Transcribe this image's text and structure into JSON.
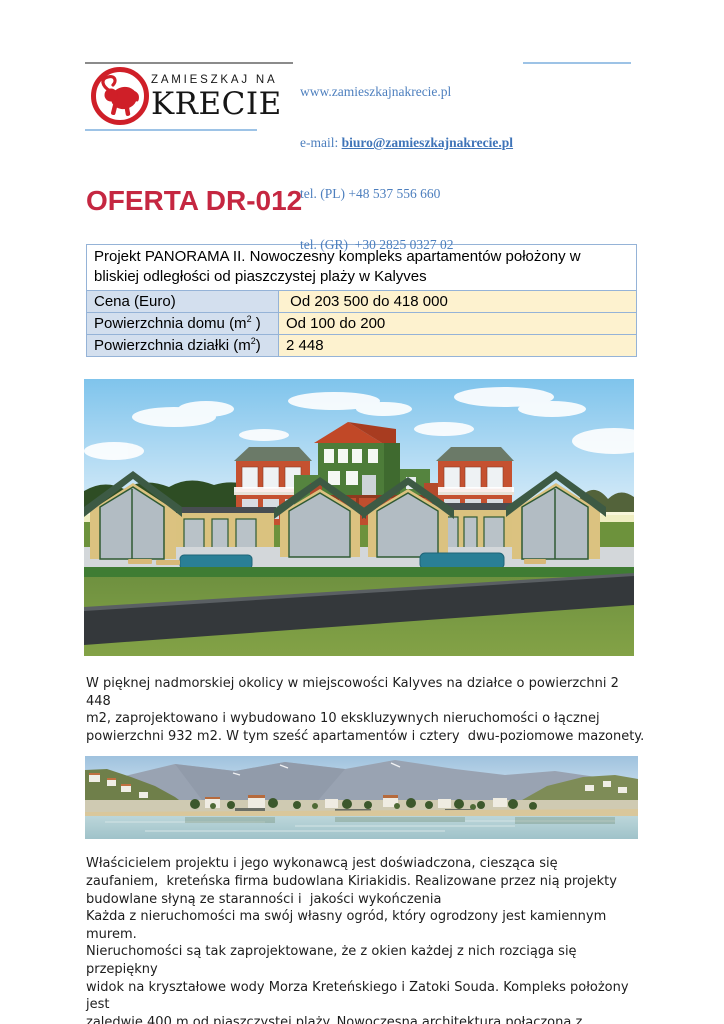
{
  "header": {
    "logo": {
      "line1": "ZAMIESZKAJ NA",
      "line2": "KRECIE",
      "icon": "bull-icon"
    },
    "website": "www.zamieszkajnakrecie.pl",
    "email_label": "e-mail: ",
    "email": "biuro@zamieszkajnakrecie.pl",
    "phone_pl": "tel. (PL) +48 537 556 660",
    "phone_gr": "tel. (GR)  +30 2825 0327 02"
  },
  "title": "OFERTA DR-012",
  "offer_table": {
    "header": "Projekt PANORAMA II. Nowoczesny kompleks apartamentów położony w bliskiej odległości od piaszczystej plaży w Kalyves",
    "rows": [
      {
        "label": "Cena (Euro)",
        "sup": "",
        "label_tail": "",
        "value": " Od 203 500 do 418 000"
      },
      {
        "label": "Powierzchnia domu (m",
        "sup": "2",
        "label_tail": " )",
        "value": "Od 100 do 200"
      },
      {
        "label": "Powierzchnia działki (m",
        "sup": "2",
        "label_tail": ")",
        "value": "2 448"
      }
    ]
  },
  "images": {
    "render_alt": "3D render of the Panorama II apartment complex: beige gabled houses with green roofs and pools, red and green two-storey buildings behind, lawn and road in front",
    "beach_alt": "Panoramic photo of Kalyves beach with mountains, village buildings, trees, sand and calm sea"
  },
  "paragraph1": {
    "lines": [
      "W pięknej nadmorskiej okolicy w miejscowości Kalyves na działce o powierzchni 2 448",
      "m2, zaprojektowano i wybudowano 10 ekskluzywnych nieruchomości o łącznej",
      "powierzchni 932 m2. W tym sześć apartamentów i cztery  dwu-poziomowe mazonety."
    ]
  },
  "paragraph2": {
    "lines": [
      "Właścicielem projektu i jego wykonawcą jest doświadczona, ciesząca się",
      "zaufaniem,  kreteńska firma budowlana Kiriakidis. Realizowane przez nią projekty",
      "budowlane słyną ze staranności i  jakości wykończenia",
      "Każda z nieruchomości ma swój własny ogród, który ogrodzony jest kamiennym murem.",
      "Nieruchomości są tak zaprojektowane, że z okien każdej z nich rozciąga się przepiękny",
      "widok na kryształowe wody Morza Kreteńskiego i Zatoki Souda. Kompleks położony jest",
      "zaledwie 400 m od piaszczystej plaży. Nowoczesna architektura połączona z tradycyjnym"
    ]
  },
  "colors": {
    "title_red": "#c52741",
    "logo_red": "#cf1f28",
    "contact_blue": "#4d7fbe",
    "rule_light_blue": "#9dc3e6",
    "rule_gray": "#8b8b8b",
    "table_border": "#95b3d7",
    "table_label_bg": "#d3dfee",
    "table_value_bg": "#fdf2cf"
  }
}
